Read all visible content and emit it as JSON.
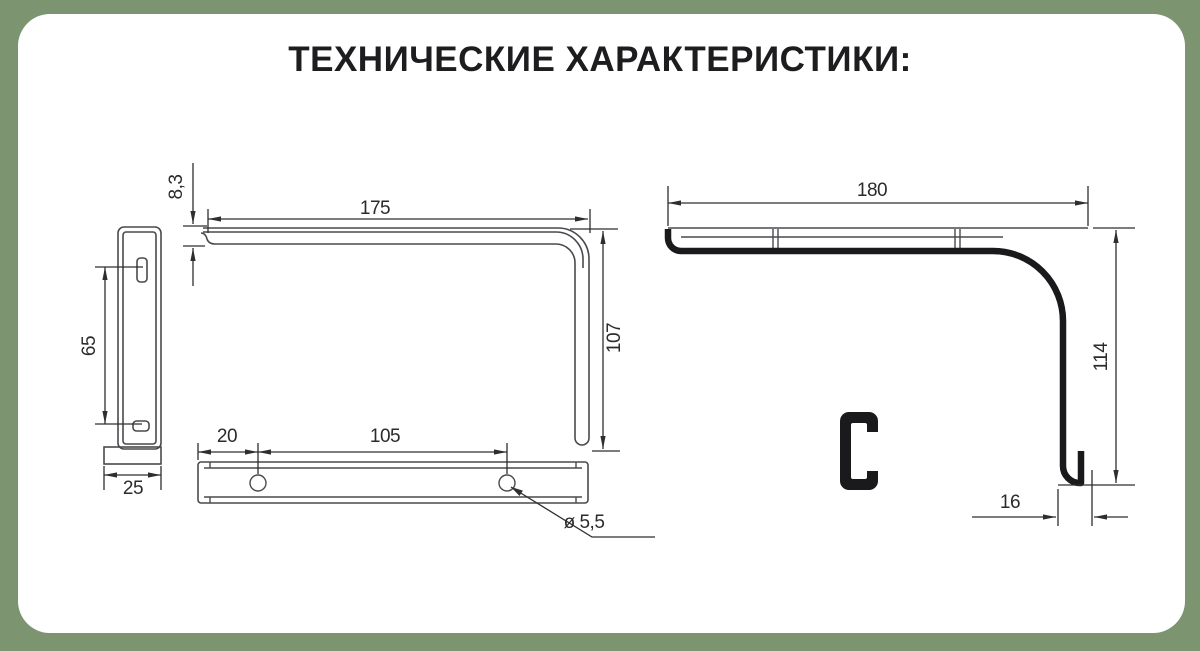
{
  "page": {
    "title": "ТЕХНИЧЕСКИЕ ХАРАКТЕРИСТИКИ:"
  },
  "colors": {
    "background": "#7d9471",
    "panel": "#ffffff",
    "title": "#1d1d1f",
    "line": "#4a4a4e",
    "thick": "#1a1a1c",
    "dim": "#2e2e30",
    "dim-text": "#2b2b2d"
  },
  "drawing": {
    "description": "Dimensional drawing of a shelf bracket: side view of wall plate, front view of L-profile, bottom view with mounting holes, and overall bracket profile with hook and channel cross-section",
    "dimensions": {
      "flange_thickness": "8,3",
      "arm_length": "175",
      "arm_height": "107",
      "slot_spacing": "65",
      "plate_width": "25",
      "hole_edge_offset": "20",
      "hole_spacing": "105",
      "hole_diameter": "ø 5,5",
      "overall_length": "180",
      "overall_height": "114",
      "hook_width": "16"
    }
  }
}
